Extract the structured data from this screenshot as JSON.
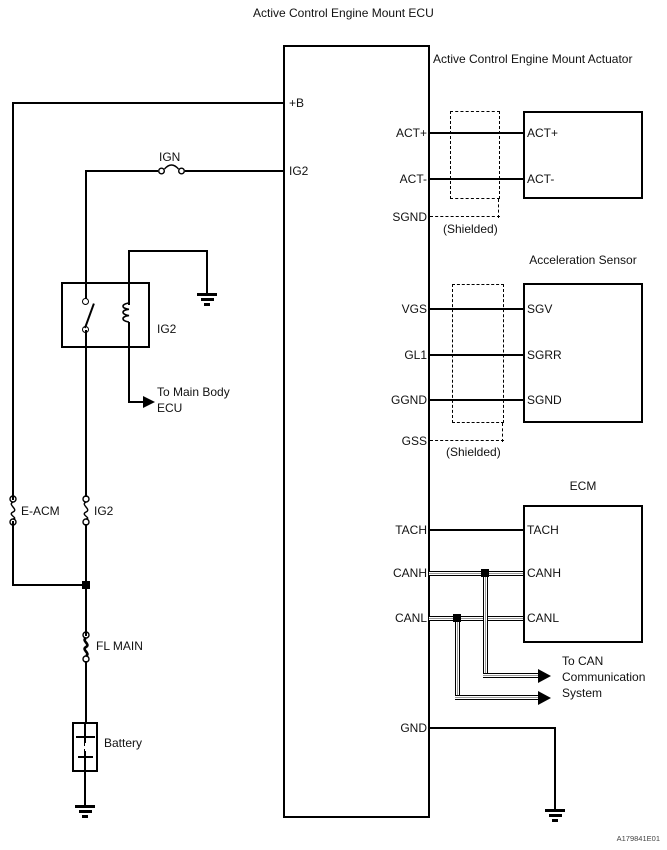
{
  "title": "Active Control Engine Mount ECU",
  "figure_code": "A179841E01",
  "colors": {
    "wire": "#000000",
    "ribbon_gray": "#999999",
    "background": "#ffffff"
  },
  "ecu": {
    "left_pins": [
      "+B",
      "IG2"
    ],
    "right_pins": [
      "ACT+",
      "ACT-",
      "SGND",
      "VGS",
      "GL1",
      "GGND",
      "GSS",
      "TACH",
      "CANH",
      "CANL",
      "GND"
    ]
  },
  "actuator": {
    "title": "Active Control Engine Mount Actuator",
    "pins": [
      "ACT+",
      "ACT-"
    ]
  },
  "sensor": {
    "title": "Acceleration Sensor",
    "pins": [
      "SGV",
      "SGRR",
      "SGND"
    ]
  },
  "ecm": {
    "title": "ECM",
    "pins": [
      "TACH",
      "CANH",
      "CANL"
    ]
  },
  "power": {
    "ign_fuse": "IGN",
    "relay_label": "IG2",
    "relay_dest_line1": "To Main Body",
    "relay_dest_line2": "ECU",
    "eacm_fuse": "E-ACM",
    "ig2_fuse": "IG2",
    "fl_main_fuse": "FL MAIN",
    "battery": "Battery"
  },
  "shield_notes": [
    "(Shielded)",
    "(Shielded)"
  ],
  "can_note": [
    "To CAN",
    "Communication",
    "System"
  ]
}
